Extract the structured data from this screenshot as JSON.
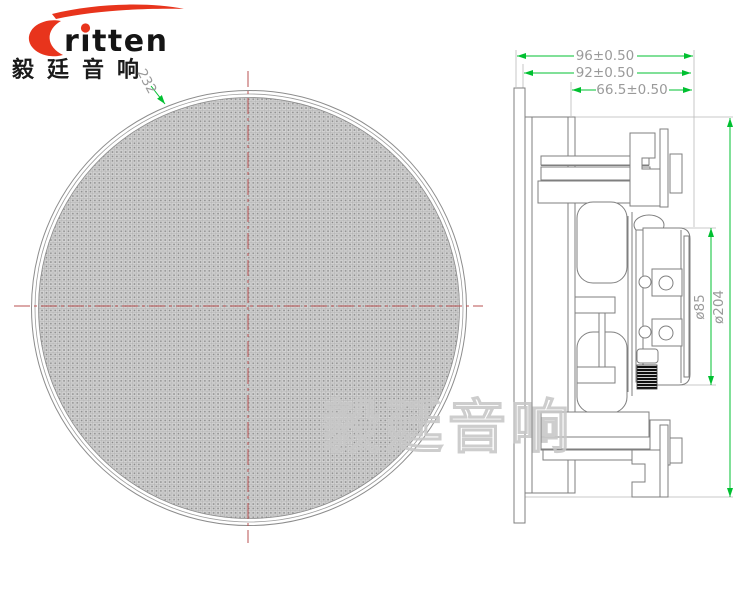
{
  "header": {
    "logo_word": "ritten",
    "logo_cn": "毅廷音响"
  },
  "watermark_text": "毅廷音响",
  "front_view": {
    "diameter_label": "232"
  },
  "side_view": {
    "dim_total_depth": "96±0.50",
    "dim_body_depth": "92±0.50",
    "dim_rear_depth": "66.5±0.50",
    "dim_magnet_diameter": "ø85",
    "dim_cutout_diameter": "ø204"
  },
  "colors": {
    "dimension_line_green": "#00c030",
    "dimension_text_gray": "#9a9a9a",
    "centerline_red": "#b85050",
    "drawing_line_gray": "#7f7f7f",
    "logo_red": "#e8341c",
    "watermark_gray": "#c8c8c8",
    "mesh_base_gray": "#d2d2d2"
  }
}
